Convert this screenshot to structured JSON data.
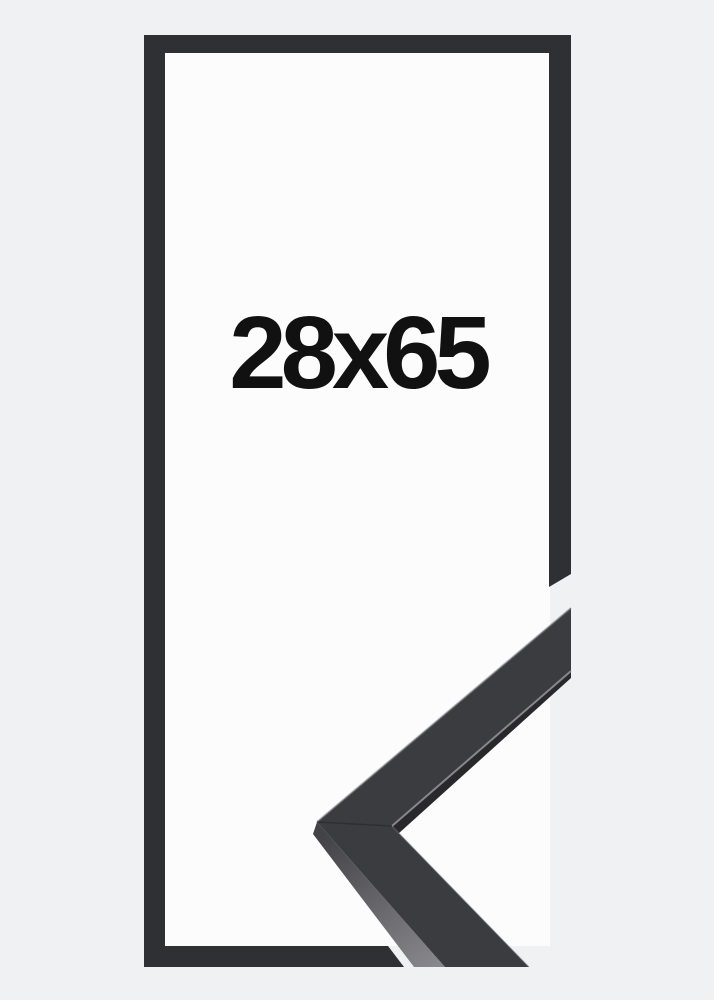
{
  "product": {
    "size_label": "28x65"
  },
  "colors": {
    "background": "#f0f1f2",
    "frame_interior": "#fcfcfd",
    "frame_outline": "#2f3033",
    "sample_top_face": "#3b3c3f",
    "sample_side_top": "#434347",
    "sample_side_bottom": "#87878c",
    "sample_inner_shadow": "#29292b",
    "edge_highlight_outer": "#77777b",
    "edge_highlight_inner": "#9a9a9e",
    "edge_highlight_lower": "#8a8a8e",
    "miter_seam": "#232325",
    "label_text": "#111111"
  }
}
